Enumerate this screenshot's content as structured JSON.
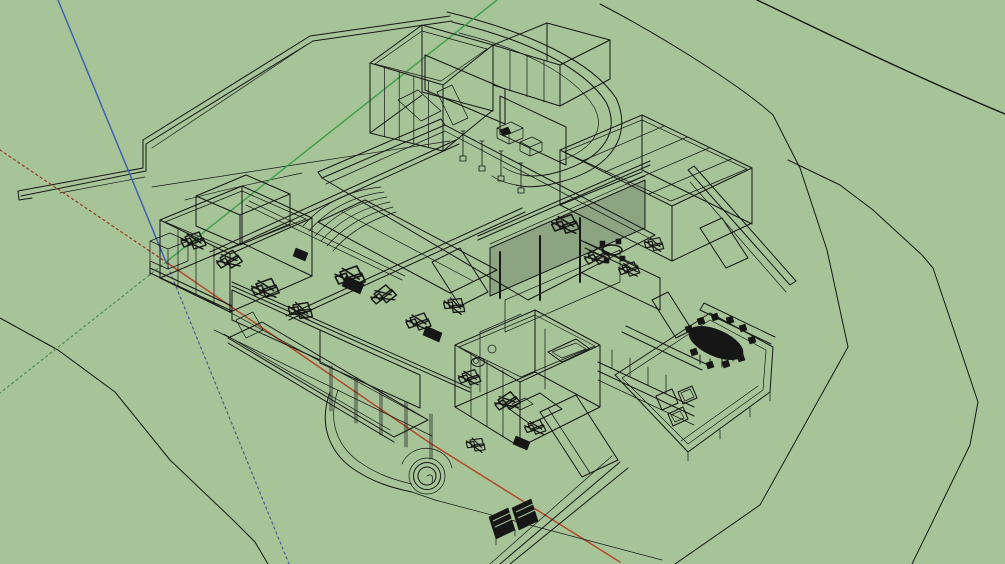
{
  "app": {
    "name": "3d-modeler-viewport",
    "description": "Perspective wireframe (x-ray) view of a modern hillside house model on a green terrain field, SketchUp-style, with drawing axes visible. No text, menus or toolbars are visible in the capture.",
    "visible_text": []
  },
  "colors": {
    "bg": "#a7c499",
    "ink": "#161616",
    "axis_red": "#b04a2a",
    "axis_red_neg": "#9c4024",
    "axis_green": "#42a04b",
    "axis_green_neg": "#4f9055",
    "axis_blue": "#3e63b0",
    "axis_blue_neg": "#49638c"
  },
  "axes": {
    "origin_px": [
      166,
      262
    ],
    "blue_solid": "up-left to top edge",
    "blue_dotted": "down-right (below ground)",
    "red_solid": "down-right to bottom edge",
    "red_dotted": "up-left to left edge",
    "green_solid": "up-right to top edge",
    "green_dotted": "down-left to left edge"
  },
  "scene": {
    "objects": [
      "terrain-contour-lines",
      "hillside-retaining-walls",
      "curved-driveway-loop",
      "upper-pavilion-garage",
      "central-roof-terrace",
      "amphitheater-steps",
      "grand-stair",
      "courtyard-louver-wall",
      "left-bedroom-wing",
      "glazed-front-facade",
      "lower-bedroom-wing",
      "right-living-wing",
      "outdoor-dining-table-with-chairs",
      "patio-deck",
      "lounge-furniture",
      "boardwalk-deck",
      "garden-path",
      "round-planter",
      "solar-panels"
    ]
  }
}
